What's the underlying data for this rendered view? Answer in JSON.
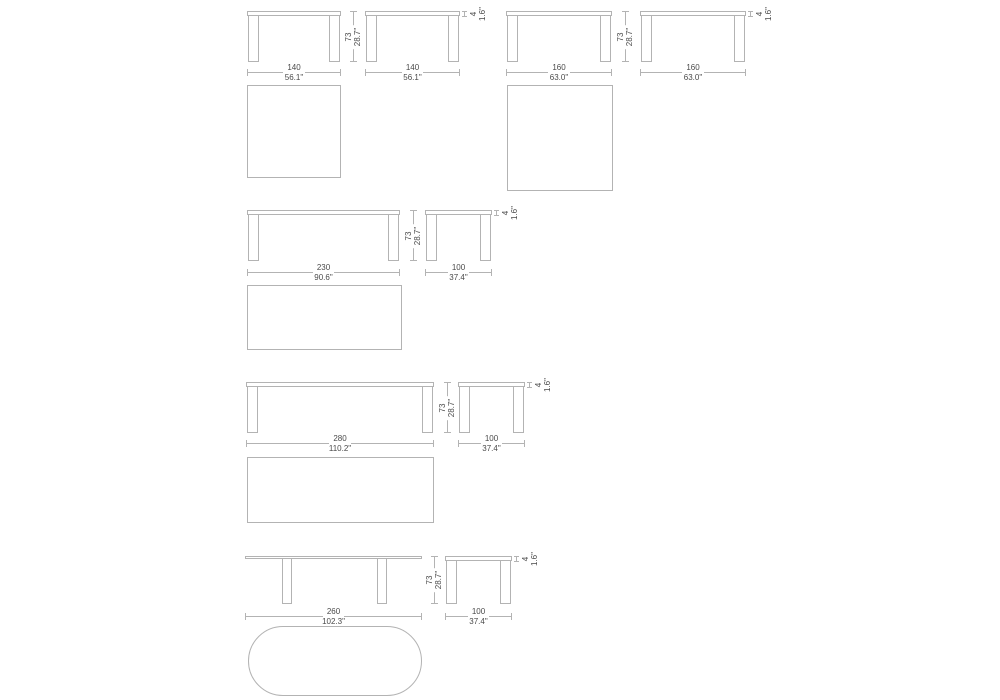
{
  "page": {
    "background": "#ffffff",
    "line_color": "#b3b3b3",
    "text_color": "#4a4a4a"
  },
  "figures": [
    {
      "name": "table-140",
      "front": {
        "width_cm": "140",
        "width_in": "56.1\""
      },
      "side": {
        "width_cm": "140",
        "width_in": "56.1\""
      },
      "height": {
        "cm": "73",
        "in": "28.7\""
      },
      "thickness": {
        "cm": "4",
        "in": "1.6\""
      },
      "top_view": "square"
    },
    {
      "name": "table-160",
      "front": {
        "width_cm": "160",
        "width_in": "63.0\""
      },
      "side": {
        "width_cm": "160",
        "width_in": "63.0\""
      },
      "height": {
        "cm": "73",
        "in": "28.7\""
      },
      "thickness": {
        "cm": "4",
        "in": "1.6\""
      },
      "top_view": "square"
    },
    {
      "name": "table-230",
      "front": {
        "width_cm": "230",
        "width_in": "90.6\""
      },
      "side": {
        "width_cm": "100",
        "width_in": "37.4\""
      },
      "height": {
        "cm": "73",
        "in": "28.7\""
      },
      "thickness": {
        "cm": "4",
        "in": "1.6\""
      },
      "top_view": "rectangle"
    },
    {
      "name": "table-280",
      "front": {
        "width_cm": "280",
        "width_in": "110.2\""
      },
      "side": {
        "width_cm": "100",
        "width_in": "37.4\""
      },
      "height": {
        "cm": "73",
        "in": "28.7\""
      },
      "thickness": {
        "cm": "4",
        "in": "1.6\""
      },
      "top_view": "rectangle"
    },
    {
      "name": "table-260-oval",
      "front": {
        "width_cm": "260",
        "width_in": "102.3\""
      },
      "side": {
        "width_cm": "100",
        "width_in": "37.4\""
      },
      "height": {
        "cm": "73",
        "in": "28.7\""
      },
      "thickness": {
        "cm": "4",
        "in": "1.6\""
      },
      "top_view": "oval"
    }
  ]
}
